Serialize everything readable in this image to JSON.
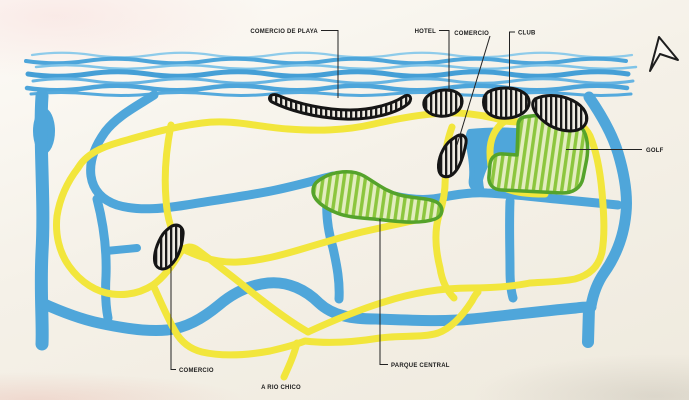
{
  "labels": {
    "comercio_de_playa": "COMERCIO DE PLAYA",
    "hotel": "HOTEL",
    "comercio_top": "COMERCIO",
    "club": "CLUB",
    "golf": "GOLF",
    "comercio_left": "COMERCIO",
    "a_rio_chico": "A RIO CHICO",
    "parque_central": "PARQUE CENTRAL"
  },
  "icons": {
    "compass": "north-arrow"
  },
  "colors": {
    "background": "#f4f0e7",
    "sea_blue": "#4da5da",
    "road_blue": "#4fa6da",
    "road_yellow": "#f2e63c",
    "green_fill": "#8cc63e",
    "green_outline": "#55a32b",
    "black_area": "#151515",
    "label_text": "#1c1c1c"
  }
}
